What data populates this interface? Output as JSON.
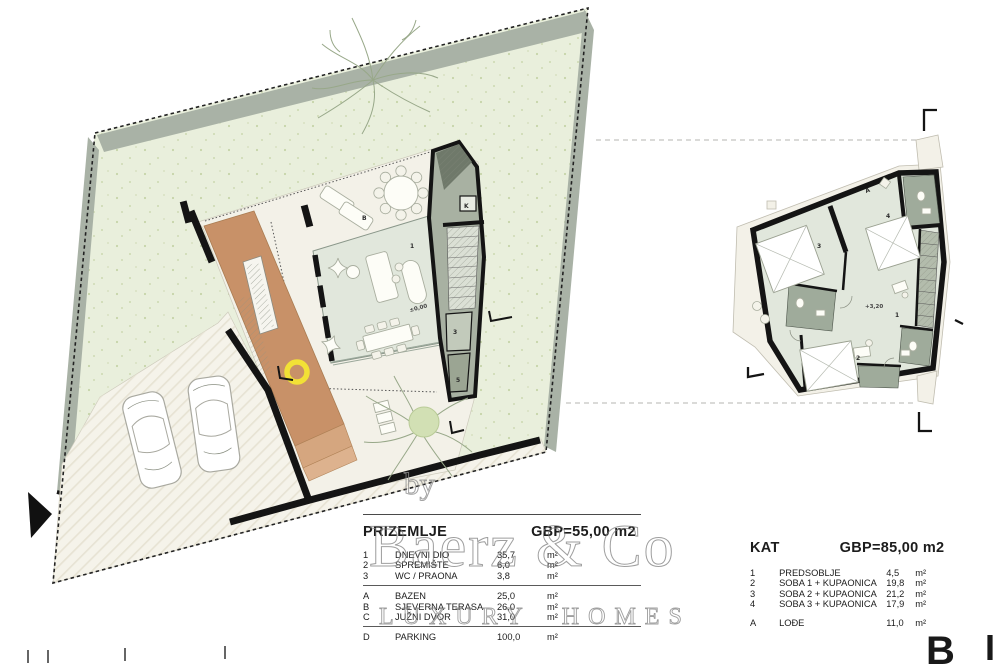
{
  "colors": {
    "lawn": "#e9efdc",
    "road_band": "#a9b2a6",
    "paving": "#f5f3ea",
    "deck": "#c89168",
    "interior_floor": "#e1e7dc",
    "wet_room": "#9fab9b",
    "wall": "#141414",
    "accent_yellow": "#f2e136",
    "watermark_gray": "#8f8f8f"
  },
  "ground_legend": {
    "title": "PRIZEMLJE",
    "gbp": "GBP=55,00 m2",
    "rooms": [
      {
        "num": "1",
        "name": "DNEVNI DIO",
        "area": "35,7",
        "unit": "m²"
      },
      {
        "num": "2",
        "name": "SPREMIŠTE",
        "area": "6,0",
        "unit": "m²"
      },
      {
        "num": "3",
        "name": "WC / PRAONA",
        "area": "3,8",
        "unit": "m²"
      }
    ],
    "outdoor": [
      {
        "num": "A",
        "name": "BAZEN",
        "area": "25,0",
        "unit": "m²"
      },
      {
        "num": "B",
        "name": "SJEVERNA TERASA",
        "area": "26,0",
        "unit": "m²"
      },
      {
        "num": "C",
        "name": "JUŽNI DVOR",
        "area": "31,0",
        "unit": "m²"
      }
    ],
    "parking": [
      {
        "num": "D",
        "name": "PARKING",
        "area": "100,0",
        "unit": "m²"
      }
    ]
  },
  "upper_legend": {
    "title": "KAT",
    "gbp": "GBP=85,00 m2",
    "rooms": [
      {
        "num": "1",
        "name": "PREDSOBLJE",
        "area": "4,5",
        "unit": "m²"
      },
      {
        "num": "2",
        "name": "SOBA 1 + KUPAONICA",
        "area": "19,8",
        "unit": "m²"
      },
      {
        "num": "3",
        "name": "SOBA 2 + KUPAONICA",
        "area": "21,2",
        "unit": "m²"
      },
      {
        "num": "4",
        "name": "SOBA 3 + KUPAONICA",
        "area": "17,9",
        "unit": "m²"
      }
    ],
    "outdoor": [
      {
        "num": "A",
        "name": "LOĐE",
        "area": "11,0",
        "unit": "m²"
      }
    ]
  },
  "ground_plan_labels": {
    "terrace": "B",
    "living": "1",
    "wc": "3",
    "store": "5",
    "kitchen": "K",
    "level": "±0,00"
  },
  "upper_plan_labels": {
    "loggia": "A",
    "hall": "1",
    "room2": "2",
    "room3": "3",
    "room4": "4",
    "level": "+3,20"
  },
  "watermark": {
    "by": "by",
    "brand": "Baerz & Co",
    "tagline": "LUXURY HOMES"
  },
  "corner_letters": {
    "left": "B",
    "right": "I"
  }
}
